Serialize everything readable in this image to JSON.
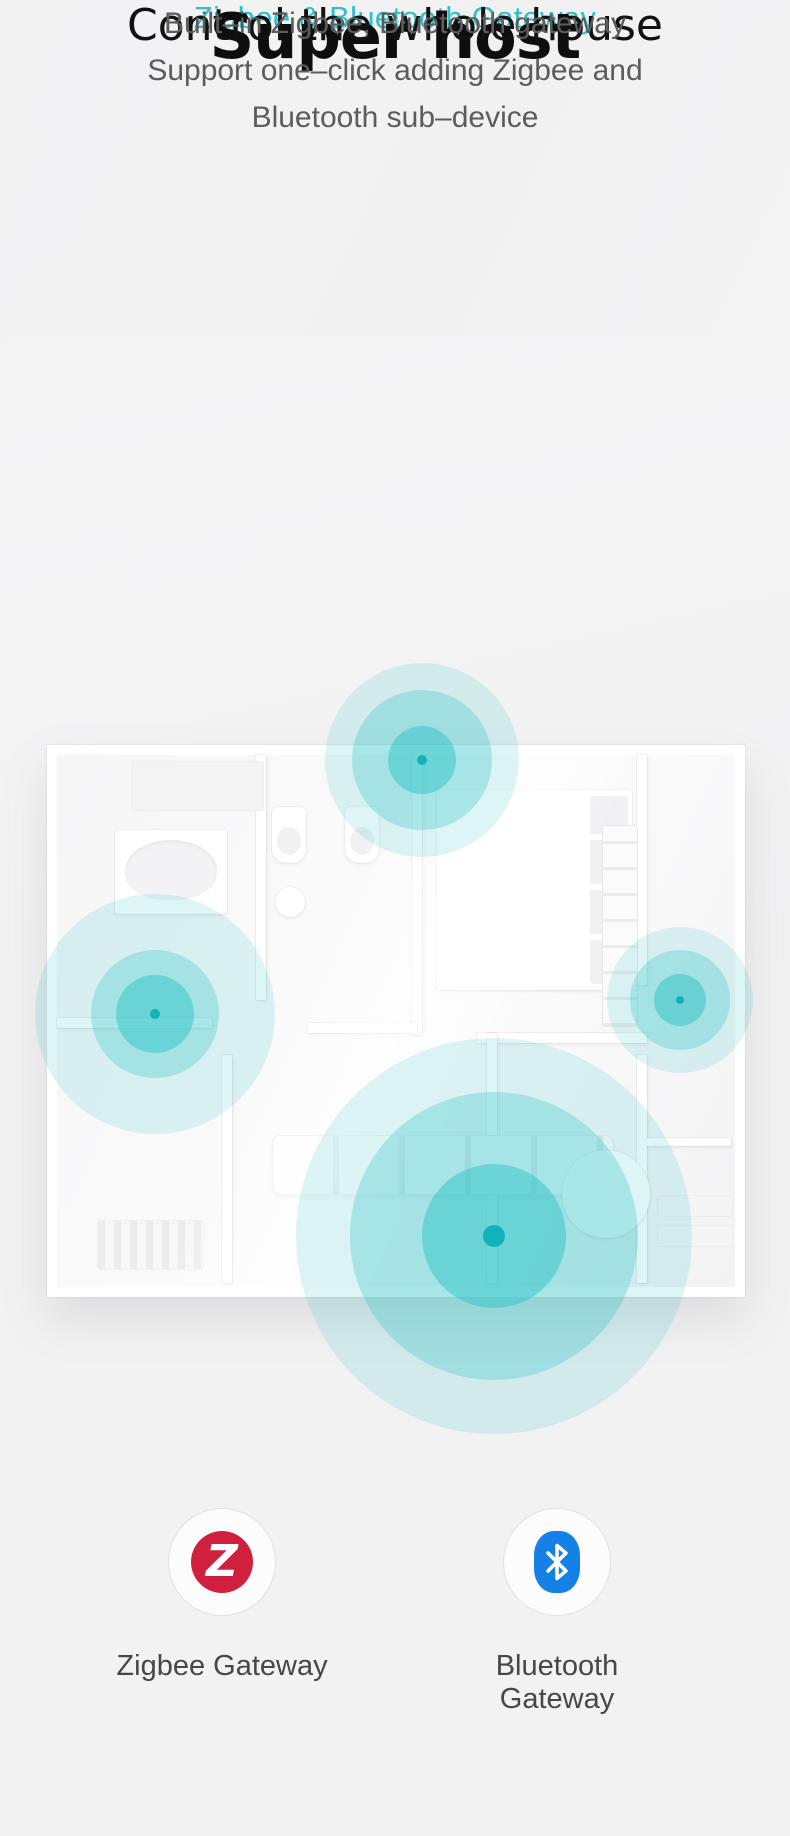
{
  "page": {
    "background": "#f2f2f3"
  },
  "colors": {
    "accent_teal": "#2fc0cd",
    "ripple_teal": "#2fc3c7",
    "ripple_dot_teal": "#12b2bc",
    "zigbee_red": "#d1203d",
    "bluetooth_blue": "#1581e6",
    "title_black": "#0e0e0e",
    "body_gray": "#5c5c5c"
  },
  "hero": {
    "eyebrow": "Zigbee & Bluetooth Gateway",
    "title": "Super host",
    "subtitle": "Control the whole house",
    "description_lines": [
      "Built–in Zigbee, Bluetooth gateway",
      "Support one–click adding Zigbee and",
      "Bluetooth sub–device"
    ]
  },
  "floorplan": {
    "ripples": [
      {
        "name": "bathroom-signal-ripple",
        "x": 422,
        "y": 760,
        "outer": 97,
        "mid": 70,
        "inner": 34,
        "dot": 5
      },
      {
        "name": "left-room-signal-ripple",
        "x": 155,
        "y": 1014,
        "outer": 120,
        "mid": 64,
        "inner": 39,
        "dot": 5
      },
      {
        "name": "right-room-signal-ripple",
        "x": 680,
        "y": 1000,
        "outer": 73,
        "mid": 50,
        "inner": 26,
        "dot": 4
      },
      {
        "name": "living-room-signal-ripple",
        "x": 494,
        "y": 1236,
        "outer": 198,
        "mid": 144,
        "inner": 72,
        "dot": 11
      }
    ]
  },
  "features": [
    {
      "label": "Zigbee Gateway",
      "icon": "zigbee-logo-icon",
      "icon_glyph": "Z"
    },
    {
      "label": "Bluetooth Gateway",
      "icon": "bluetooth-logo-icon"
    }
  ]
}
